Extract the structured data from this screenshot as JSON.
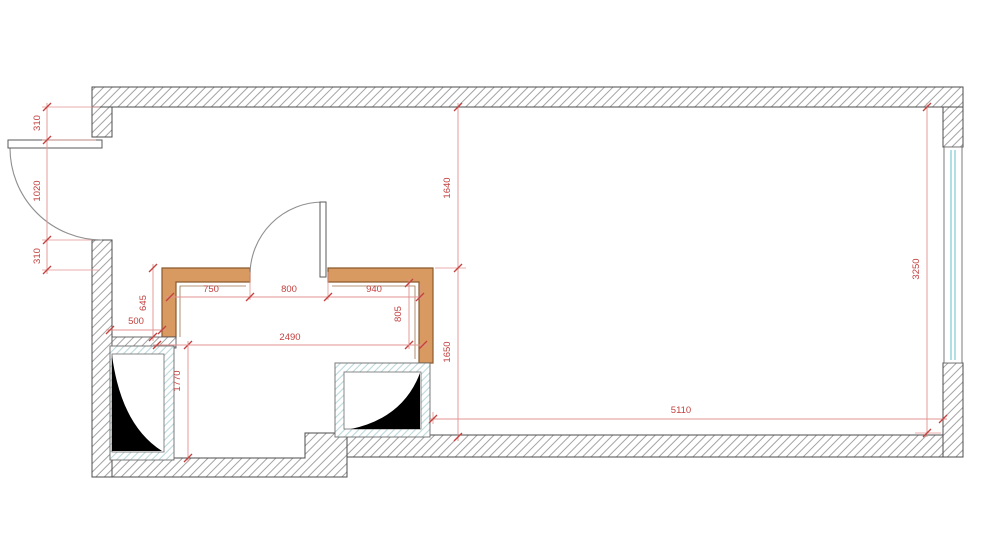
{
  "colors": {
    "dimension_red": "#c24240",
    "partition_fill": "#d89a60",
    "partition_outline": "#8a5a2e",
    "window_glazing": "#a7dde2",
    "shaft_fill": "#000000",
    "wall_hatch": "#a3a3a3"
  },
  "dimensions": {
    "entry_top_offset": "310",
    "entry_door": "1020",
    "entry_bottom_offset": "310",
    "top_to_partition": "1640",
    "partition_to_bottom": "1650",
    "right_wall_window": "3250",
    "partition_left_height": "645",
    "left_wall_to_partition": "500",
    "bath_top_seg_left": "750",
    "bath_door_opening": "800",
    "bath_top_seg_right": "940",
    "bath_inner_width": "2490",
    "bath_inner_depth": "1770",
    "bath_right_inner": "805",
    "main_room_bottom_width": "5110"
  }
}
